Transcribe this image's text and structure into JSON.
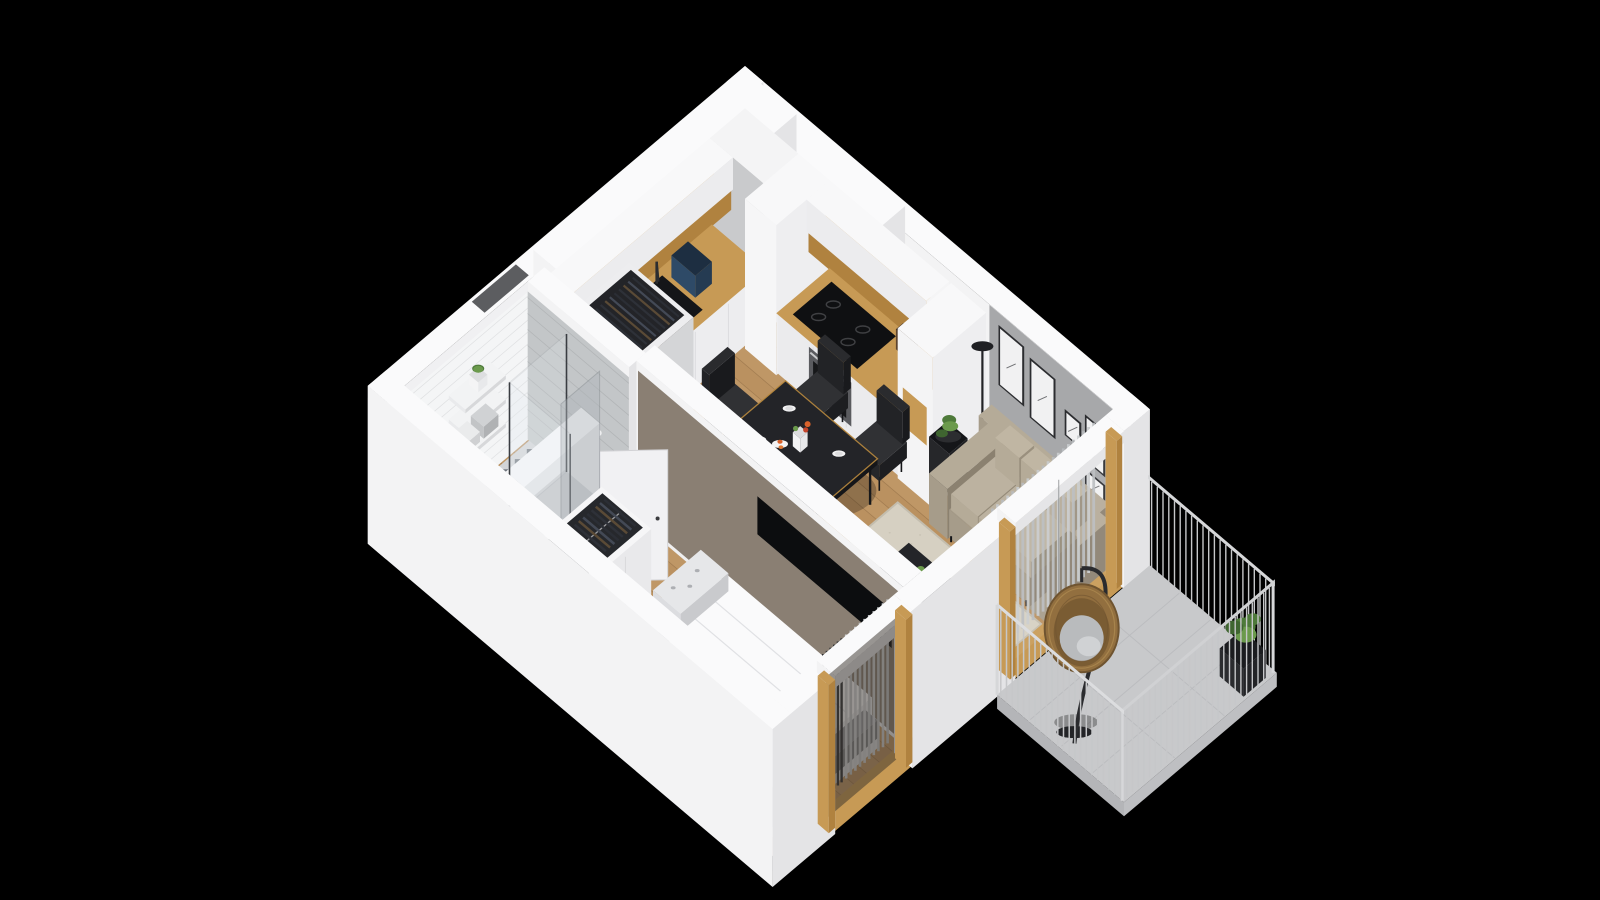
{
  "scene": {
    "type": "isometric-3d-apartment-floorplan",
    "background": "black",
    "rooms": [
      {
        "name": "kitchen",
        "items": [
          "white-cabinets",
          "oak-countertop",
          "sink",
          "faucet",
          "coffee-machine",
          "kettle",
          "fruit-bowl",
          "cooktop",
          "oven",
          "tall-cabinets",
          "soffit"
        ]
      },
      {
        "name": "dining-area",
        "items": [
          "black-dining-table",
          "four-black-chairs",
          "plates",
          "vase-with-flowers",
          "fruit-plate"
        ]
      },
      {
        "name": "living-room",
        "items": [
          "beige-sofa",
          "black-coffee-table",
          "area-rug",
          "plant-stand",
          "floor-lamp",
          "tv-on-partition",
          "gallery-wall-art",
          "curtains",
          "floor-plant"
        ]
      },
      {
        "name": "bedroom",
        "items": [
          "double-bed",
          "white-duvet",
          "patterned-pillows",
          "open-wardrobe-with-clothes",
          "window-curtains",
          "open-door"
        ]
      },
      {
        "name": "bathroom",
        "items": [
          "wall-hung-toilet",
          "concealed-cistern",
          "shower-glass",
          "shelves-with-towels",
          "plant",
          "toilet-paper",
          "patterned-tile-floor"
        ]
      },
      {
        "name": "hallway",
        "items": [
          "entry-door",
          "wardrobe-cabinet-with-clothes",
          "shelf-with-books"
        ]
      },
      {
        "name": "balcony",
        "items": [
          "hanging-egg-chair",
          "metal-railing",
          "potted-plant",
          "concrete-floor"
        ]
      }
    ]
  },
  "colors": {
    "background": "#000000",
    "wallTop": "#fafafb",
    "wallRight": "#e4e4e6",
    "wallLeft": "#f3f3f4",
    "wallInner": "#f0f0f2",
    "grayWall": "#a7a8aa",
    "taupe": "#8a7f73",
    "wood": "#ba9160",
    "woodLight": "#c8a272",
    "woodSeam": "#8f6c44",
    "oak": "#c79a55",
    "oakDark": "#b0823f",
    "gold": "#b98a3e",
    "dark": "#1a1b1e",
    "steel": "#5a5b5f",
    "sofa": "#a69c8a",
    "sofaLight": "#b5ab98",
    "sofaDark": "#8b8170",
    "rug": "#d6d0c2",
    "curtain": "#c9ccce",
    "curtainDark": "#b9bcbf",
    "balconyFloor": "#c8c9cb",
    "rail": "#c6c7c9",
    "railTop": "#d6d7d9",
    "rattan": "#926f3f",
    "rattanDark": "#6f5430",
    "cushion": "#b9bbbd",
    "plantGreen": "#4e7a3a",
    "plantLight": "#6b9a4c",
    "apple": "#6fae3e",
    "flower": "#d9622b",
    "bathFloor": "#d2d4d7",
    "bathMotif": "#565c66",
    "tileWhite": "#f4f5f6",
    "tileGray": "#c3c6c8",
    "glass": "#e8eef2"
  }
}
